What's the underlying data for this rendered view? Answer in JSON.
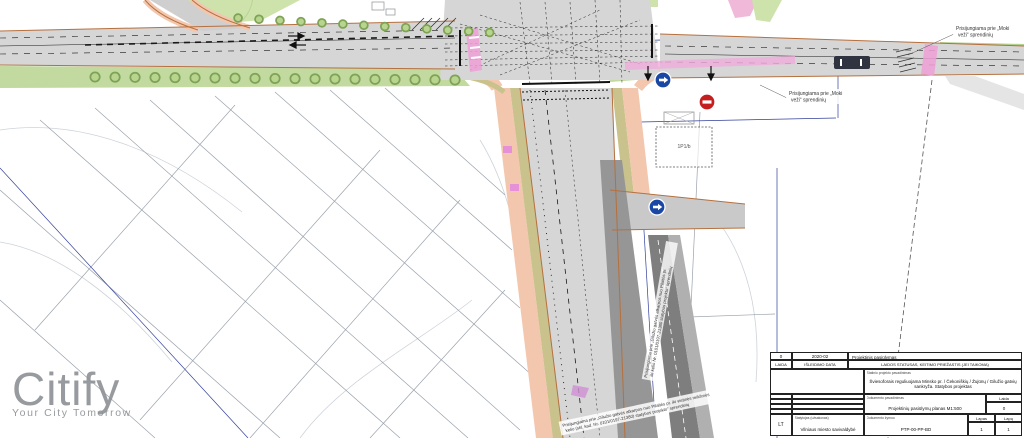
{
  "logo": {
    "brand": "Citify",
    "tagline": "Your City Tomorrow",
    "color": "#8f9296"
  },
  "colors": {
    "road_light": "#d6d6d6",
    "road_dark": "#969696",
    "road_darker": "#7e7e7e",
    "sidewalk_salmon": "#f3c7ae",
    "bike_olive": "#c9c28c",
    "green_strip": "#c2d9a0",
    "tree_ring": "#7da354",
    "tree_fill": "#b9d48f",
    "crosswalk_pink": "#ee9fd6",
    "edge_orange": "#b5703f",
    "utility_navy": "#32409a",
    "sign_blue": "#1947a3",
    "sign_red": "#c41e1e"
  },
  "plan": {
    "building_label": "1P1/b",
    "annotations": {
      "moki_top": {
        "line1": "Prisijungiama prie „Moki",
        "line2": "veži“ sprendinių"
      },
      "moki_mid": {
        "line1": "Prisijungiama prie „Moki",
        "line2": "veži“ sprendinių"
      },
      "giluzio_bottom": {
        "line1": "Prisijungiama prie „Gilužio gatvės atkarpos nuo Pilaitės pr. iki vietinės reikšmės",
        "line2": "kelio (skl. kad. Nr. 0101/0197-21380) statybos projekto“ sprendinių"
      },
      "giluzio_right": {
        "line1": "Prisijungiama prie „Gilužio gatvės atkarpos nuo Pilaitės pr.",
        "line2": "iki kelio Nr. 0101/0197-21380 statybos projekto“ sprendinių"
      }
    }
  },
  "title_block": {
    "rev": {
      "laida": "0",
      "date": "2020-02",
      "status": "Projektinis pasiūlymas"
    },
    "head": {
      "laida": "LAIDA",
      "date": "IŠLEIDIMO DATA",
      "status": "LAIDOS STATUSAS, KEITIMO PRIEŽASTIS (JEI TAIKOMA)"
    },
    "project_label": "Statinio projekto pavadinimas",
    "project_name": "Šviesoforais reguliuojama Minsko pr. / Čekoniškių / Žujūnų / Gilužio gatvių sankryža. Statybos projektas",
    "document_label": "Dokumento pavadinimas",
    "document_name": "Projektinių pasiūlymų planas M1:500",
    "laida_label": "Laida",
    "laida_value": "0",
    "lang": "LT",
    "client_label": "Statytojas (užsakovas)",
    "client_name": "Vilniaus miesto savivaldybė",
    "doc_code_label": "Dokumento žymuo",
    "doc_code": "PTP-00-PP-BD",
    "sheet_label": "Lapas",
    "sheet_value": "1",
    "sheets_label": "Lapų",
    "sheets_value": "1"
  }
}
